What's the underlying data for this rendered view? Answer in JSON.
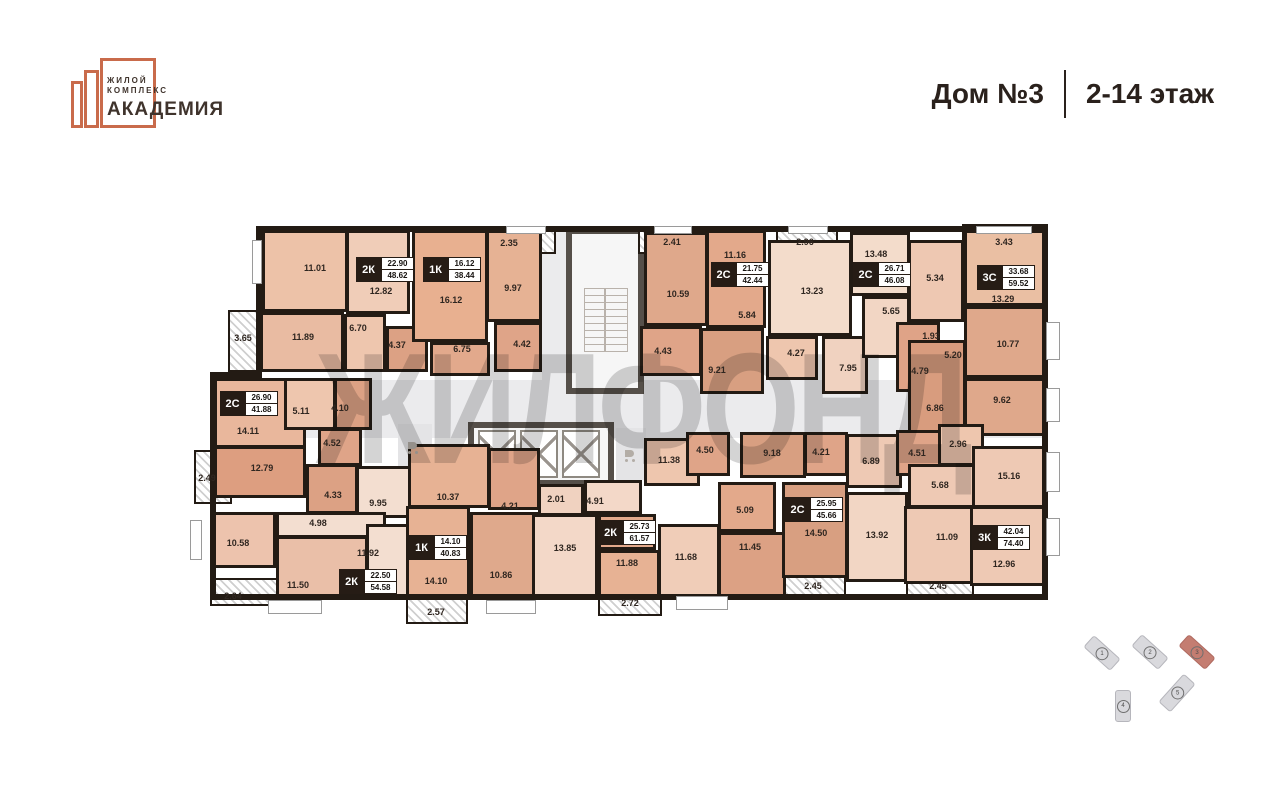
{
  "header": {
    "logo": {
      "line1": "ЖИЛОЙ",
      "line2": "КОМПЛЕКС",
      "name": "АКАДЕМИЯ"
    },
    "house": "Дом №3",
    "floors": "2-14 этаж"
  },
  "watermark": "ЖИЛФОНД",
  "colors": {
    "accent_orange": "#c96b4b",
    "wall": "#231b14",
    "minimap_highlight": "#c47d71"
  },
  "apartments": [
    {
      "type": "2К",
      "living": "22.90",
      "total": "48.62",
      "x": 356,
      "y": 257
    },
    {
      "type": "1К",
      "living": "16.12",
      "total": "38.44",
      "x": 423,
      "y": 257
    },
    {
      "type": "2С",
      "living": "21.75",
      "total": "42.44",
      "x": 711,
      "y": 262
    },
    {
      "type": "2С",
      "living": "26.71",
      "total": "46.08",
      "x": 853,
      "y": 262
    },
    {
      "type": "3С",
      "living": "33.68",
      "total": "59.52",
      "x": 977,
      "y": 265
    },
    {
      "type": "2С",
      "living": "26.90",
      "total": "41.88",
      "x": 220,
      "y": 391
    },
    {
      "type": "2К",
      "living": "22.50",
      "total": "54.58",
      "x": 339,
      "y": 569
    },
    {
      "type": "1К",
      "living": "14.10",
      "total": "40.83",
      "x": 409,
      "y": 535
    },
    {
      "type": "2К",
      "living": "25.73",
      "total": "61.57",
      "x": 598,
      "y": 520
    },
    {
      "type": "2С",
      "living": "25.95",
      "total": "45.66",
      "x": 785,
      "y": 497
    },
    {
      "type": "3К",
      "living": "42.04",
      "total": "74.40",
      "x": 972,
      "y": 525
    }
  ],
  "room_labels": [
    {
      "t": "11.01",
      "x": 315,
      "y": 268
    },
    {
      "t": "12.82",
      "x": 381,
      "y": 291
    },
    {
      "t": "16.12",
      "x": 451,
      "y": 300
    },
    {
      "t": "6.70",
      "x": 358,
      "y": 328
    },
    {
      "t": "4.37",
      "x": 397,
      "y": 345
    },
    {
      "t": "11.89",
      "x": 303,
      "y": 337
    },
    {
      "t": "3.65",
      "x": 243,
      "y": 338
    },
    {
      "t": "6.75",
      "x": 462,
      "y": 349
    },
    {
      "t": "2.35",
      "x": 509,
      "y": 243
    },
    {
      "t": "9.97",
      "x": 513,
      "y": 288
    },
    {
      "t": "4.42",
      "x": 522,
      "y": 344
    },
    {
      "t": "2.41",
      "x": 672,
      "y": 242
    },
    {
      "t": "10.59",
      "x": 678,
      "y": 294
    },
    {
      "t": "4.43",
      "x": 663,
      "y": 351
    },
    {
      "t": "11.16",
      "x": 735,
      "y": 255
    },
    {
      "t": "5.84",
      "x": 747,
      "y": 315
    },
    {
      "t": "9.21",
      "x": 717,
      "y": 370
    },
    {
      "t": "2.96",
      "x": 805,
      "y": 242
    },
    {
      "t": "13.23",
      "x": 812,
      "y": 291
    },
    {
      "t": "4.27",
      "x": 796,
      "y": 353
    },
    {
      "t": "7.95",
      "x": 848,
      "y": 368
    },
    {
      "t": "13.48",
      "x": 876,
      "y": 254
    },
    {
      "t": "5.65",
      "x": 891,
      "y": 311
    },
    {
      "t": "1.93",
      "x": 931,
      "y": 336
    },
    {
      "t": "4.79",
      "x": 920,
      "y": 371
    },
    {
      "t": "5.34",
      "x": 935,
      "y": 278
    },
    {
      "t": "3.43",
      "x": 1004,
      "y": 242
    },
    {
      "t": "13.29",
      "x": 1003,
      "y": 299
    },
    {
      "t": "10.77",
      "x": 1008,
      "y": 344
    },
    {
      "t": "9.62",
      "x": 1002,
      "y": 400
    },
    {
      "t": "5.20",
      "x": 953,
      "y": 355
    },
    {
      "t": "6.86",
      "x": 935,
      "y": 408
    },
    {
      "t": "14.11",
      "x": 248,
      "y": 431
    },
    {
      "t": "5.11",
      "x": 301,
      "y": 411
    },
    {
      "t": "4.10",
      "x": 340,
      "y": 408
    },
    {
      "t": "12.79",
      "x": 262,
      "y": 468
    },
    {
      "t": "4.52",
      "x": 332,
      "y": 443
    },
    {
      "t": "2.49",
      "x": 207,
      "y": 478
    },
    {
      "t": "4.33",
      "x": 333,
      "y": 495
    },
    {
      "t": "9.95",
      "x": 378,
      "y": 503
    },
    {
      "t": "4.98",
      "x": 318,
      "y": 523
    },
    {
      "t": "10.58",
      "x": 238,
      "y": 543
    },
    {
      "t": "11.92",
      "x": 368,
      "y": 553
    },
    {
      "t": "11.50",
      "x": 298,
      "y": 585
    },
    {
      "t": "2.64",
      "x": 233,
      "y": 596
    },
    {
      "t": "10.37",
      "x": 448,
      "y": 497
    },
    {
      "t": "4.21",
      "x": 510,
      "y": 506
    },
    {
      "t": "14.10",
      "x": 436,
      "y": 581
    },
    {
      "t": "10.86",
      "x": 501,
      "y": 575
    },
    {
      "t": "2.57",
      "x": 436,
      "y": 612
    },
    {
      "t": "2.01",
      "x": 556,
      "y": 499
    },
    {
      "t": "4.91",
      "x": 595,
      "y": 501
    },
    {
      "t": "13.85",
      "x": 565,
      "y": 548
    },
    {
      "t": "11.88",
      "x": 627,
      "y": 563
    },
    {
      "t": "11.68",
      "x": 686,
      "y": 557
    },
    {
      "t": "2.72",
      "x": 630,
      "y": 603
    },
    {
      "t": "11.38",
      "x": 669,
      "y": 460
    },
    {
      "t": "4.50",
      "x": 705,
      "y": 450
    },
    {
      "t": "9.18",
      "x": 772,
      "y": 453
    },
    {
      "t": "4.21",
      "x": 821,
      "y": 452
    },
    {
      "t": "5.09",
      "x": 745,
      "y": 510
    },
    {
      "t": "11.45",
      "x": 750,
      "y": 547
    },
    {
      "t": "14.50",
      "x": 816,
      "y": 533
    },
    {
      "t": "2.45",
      "x": 813,
      "y": 586
    },
    {
      "t": "6.89",
      "x": 871,
      "y": 461
    },
    {
      "t": "4.51",
      "x": 917,
      "y": 453
    },
    {
      "t": "2.96",
      "x": 958,
      "y": 444
    },
    {
      "t": "5.68",
      "x": 940,
      "y": 485
    },
    {
      "t": "15.16",
      "x": 1009,
      "y": 476
    },
    {
      "t": "13.92",
      "x": 877,
      "y": 535
    },
    {
      "t": "11.09",
      "x": 947,
      "y": 537
    },
    {
      "t": "12.96",
      "x": 1004,
      "y": 564
    },
    {
      "t": "2.45",
      "x": 938,
      "y": 586
    }
  ],
  "minimap": {
    "buildings": [
      {
        "n": "1",
        "highlighted": false
      },
      {
        "n": "2",
        "highlighted": false
      },
      {
        "n": "3",
        "highlighted": true
      },
      {
        "n": "4",
        "highlighted": false
      },
      {
        "n": "5",
        "highlighted": false
      }
    ]
  }
}
